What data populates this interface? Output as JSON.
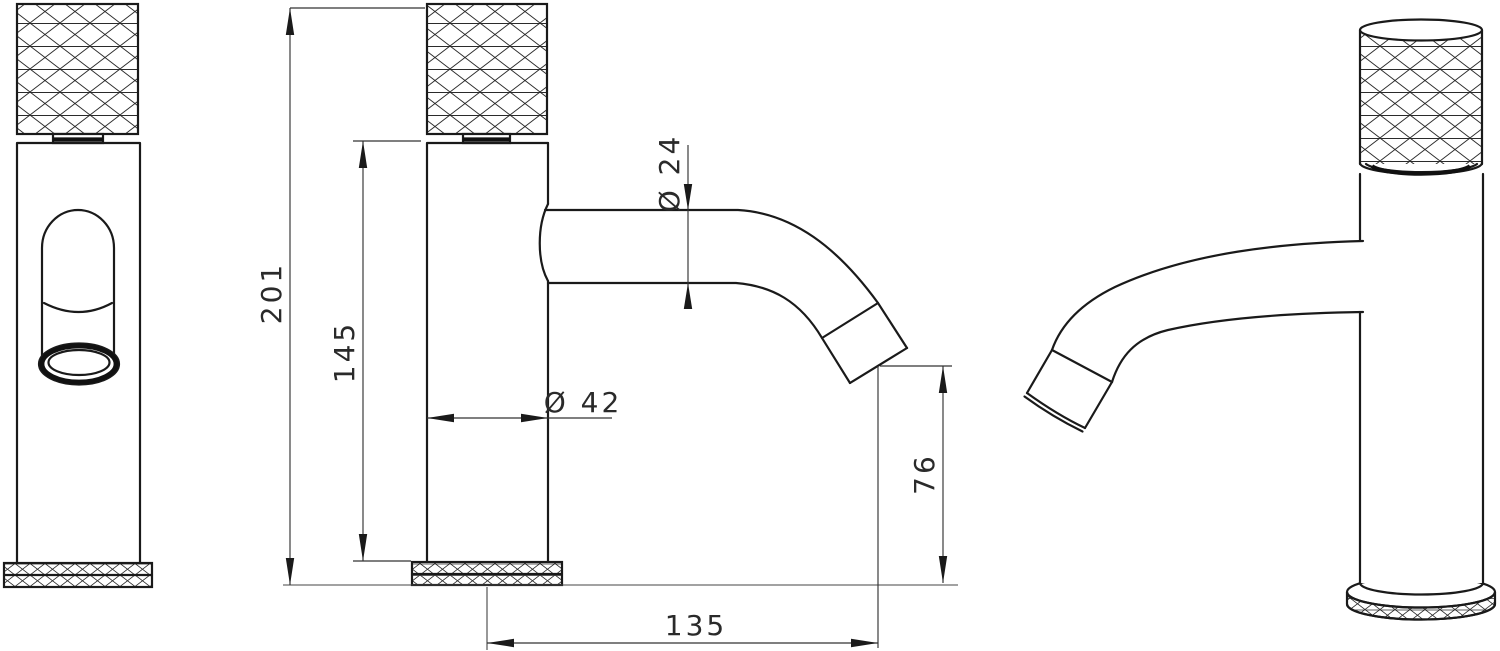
{
  "drawing": {
    "background_color": "#ffffff",
    "line_color": "#1a1a1a",
    "dimensions": {
      "overall_height": {
        "label": "201",
        "orientation": "vertical"
      },
      "body_height": {
        "label": "145",
        "orientation": "vertical"
      },
      "spout_diameter": {
        "label": "Ø 24",
        "orientation": "vertical"
      },
      "body_diameter": {
        "label": "Ø 42",
        "orientation": "horizontal"
      },
      "outlet_height": {
        "label": "76",
        "orientation": "vertical"
      },
      "spout_reach": {
        "label": "135",
        "orientation": "horizontal"
      }
    }
  }
}
